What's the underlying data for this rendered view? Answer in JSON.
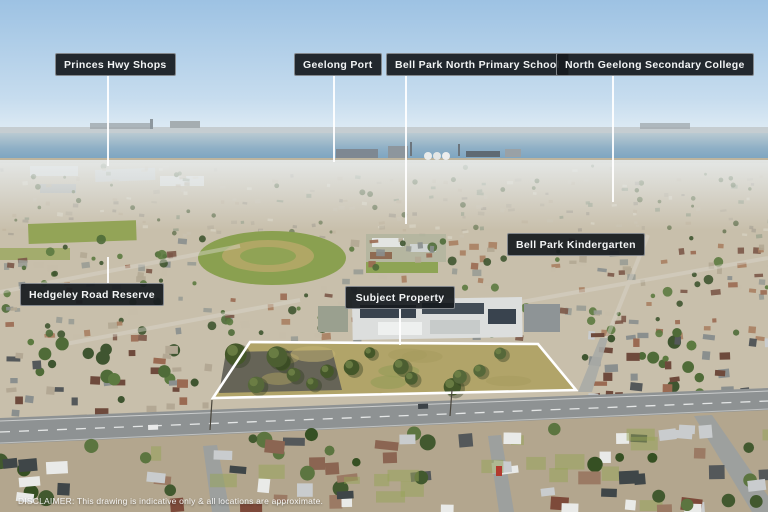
{
  "image": {
    "disclaimer": "DISCLAIMER: This drawing is indicative only & all locations are approximate."
  },
  "callouts": [
    {
      "id": "princes-hwy-shops",
      "label": "Princes Hwy Shops",
      "box": {
        "x": 55,
        "y": 53,
        "w": 107
      },
      "line": {
        "x": 107,
        "y1": 76,
        "y2": 166
      }
    },
    {
      "id": "geelong-port",
      "label": "Geelong Port",
      "box": {
        "x": 294,
        "y": 53,
        "w": 83
      },
      "line": {
        "x": 333,
        "y1": 76,
        "y2": 162
      }
    },
    {
      "id": "bell-park-north-primary-school",
      "label": "Bell Park North Primary School",
      "box": {
        "x": 386,
        "y": 53,
        "w": 159
      },
      "line": {
        "x": 405,
        "y1": 76,
        "y2": 224
      }
    },
    {
      "id": "north-geelong-secondary-college",
      "label": "North Geelong Secondary College",
      "box": {
        "x": 556,
        "y": 53,
        "w": 172
      },
      "line": {
        "x": 612,
        "y1": 76,
        "y2": 202
      }
    },
    {
      "id": "bell-park-kindergarten",
      "label": "Bell Park Kindergarten",
      "box": {
        "x": 507,
        "y": 233,
        "w": 117
      },
      "line": null
    },
    {
      "id": "hedgeley-road-reserve",
      "label": "Hedgeley Road Reserve",
      "box": {
        "x": 20,
        "y": 283,
        "w": 129
      },
      "line": {
        "x": 107,
        "y1": 257,
        "y2": 283
      }
    },
    {
      "id": "subject-property",
      "label": "Subject Property",
      "box": {
        "x": 345,
        "y": 286,
        "w": 110
      },
      "line": {
        "x": 399,
        "y1": 309,
        "y2": 345
      }
    }
  ],
  "colors": {
    "label_bg": "#171b1f",
    "label_text": "#f2f4f5",
    "leader_line": "#ffffff",
    "property_boundary": "#ffffff",
    "sky_top": "#9dc2e3",
    "water": "#7aa3bf"
  }
}
